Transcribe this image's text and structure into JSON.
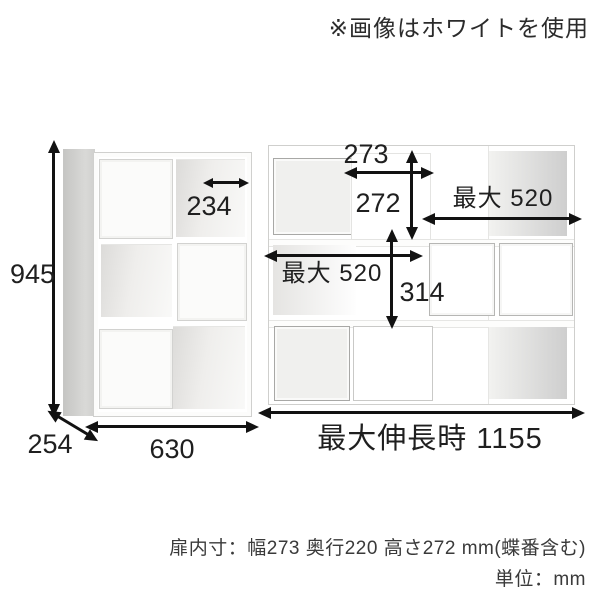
{
  "note": "※画像はホワイトを使用",
  "left_unit": {
    "state": "closed",
    "dimensions": {
      "height": "945",
      "inner_width": "234",
      "depth": "254",
      "width": "630"
    }
  },
  "right_unit": {
    "state": "extended",
    "dimensions": {
      "door_width": "273",
      "door_height": "272",
      "max_top": "最大 520",
      "max_mid": "最大 520",
      "inner_height": "314",
      "max_extension": "最大伸長時 1155"
    }
  },
  "caption": {
    "line1": "扉内寸：幅273 奥行220 高さ272 mm(蝶番含む)",
    "line2": "単位：mm"
  },
  "colors": {
    "arrow": "#121212",
    "door_fill": "#f0f0ee",
    "interior_shade": "#cecece",
    "background": "#ffffff"
  }
}
